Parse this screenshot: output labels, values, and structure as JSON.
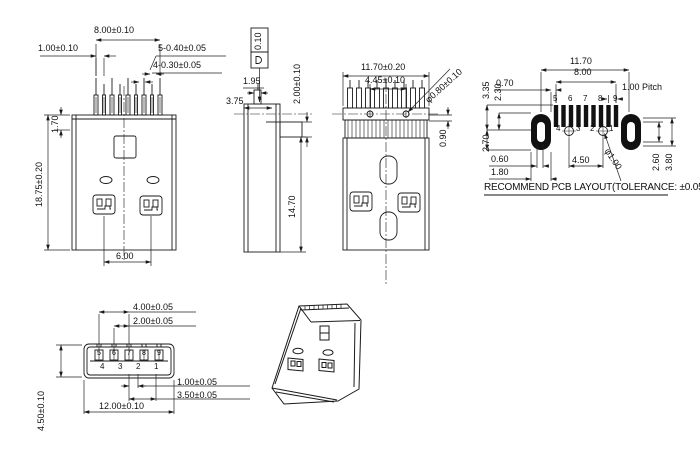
{
  "drawing": {
    "type": "USB plug connector engineering drawing",
    "front_view": {
      "w800": "8.00±0.10",
      "w100": "1.00±0.10",
      "p5": "5-0.40±0.05",
      "p4": "4-0.30±0.05",
      "h170": "1.70",
      "h1875": "18.75±0.20",
      "w600": "6.00"
    },
    "side_view": {
      "d375": "3.75",
      "d195": "1.95",
      "fcf_tolerance": "0.10",
      "d200": "2.00±0.10",
      "d1470": "14.70"
    },
    "rear_view": {
      "w1170": "11.70±0.20",
      "w445": "4.45±0.10",
      "dia080": "φ0.80±0.10",
      "h090": "0.90"
    },
    "pcb_layout": {
      "w1170": "11.70",
      "w800": "8.00",
      "w070": "0.70",
      "pitch": "1.00 Pitch",
      "h335": "3.35",
      "h230": "2.30",
      "h270": "2.70",
      "w060": "0.60",
      "w180": "1.80",
      "w450": "4.50",
      "dia100": "φ1.00",
      "h260": "2.60",
      "h380": "3.80",
      "pads_top": [
        "5",
        "6",
        "7",
        "8",
        "9"
      ],
      "pads_bottom": [
        "4",
        "3",
        "2",
        "1"
      ],
      "title": "RECOMMEND PCB LAYOUT(TOLERANCE: ±0.05)"
    },
    "bottom_view": {
      "w400": "4.00±0.05",
      "w200": "2.00±0.05",
      "w100": "1.00±0.05",
      "w350": "3.50±0.05",
      "w1200": "12.00±0.10",
      "h450": "4.50±0.10",
      "pins_top": [
        "5",
        "6",
        "7",
        "8",
        "9"
      ],
      "pins_bottom": [
        "4",
        "3",
        "2",
        "1"
      ]
    },
    "line_color": "#1a1a1a"
  }
}
